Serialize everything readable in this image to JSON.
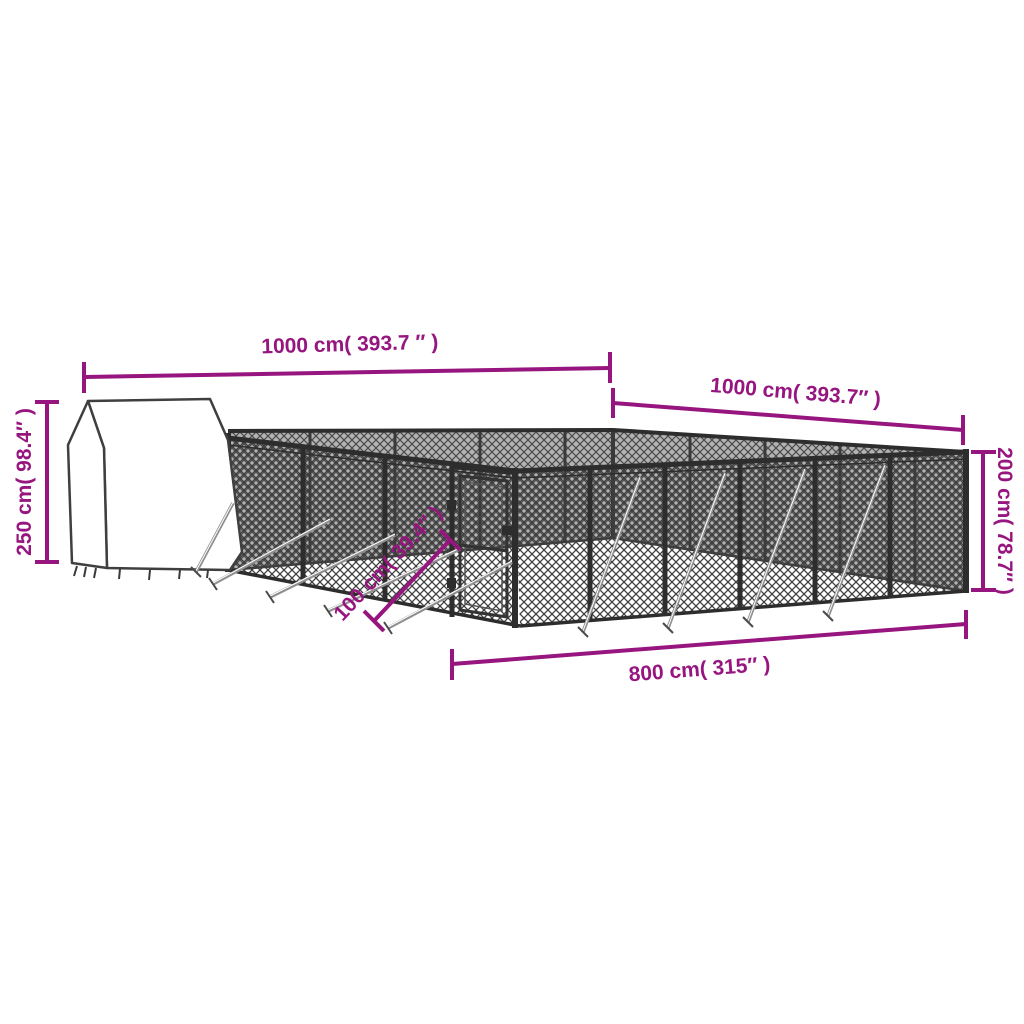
{
  "colors": {
    "dimension": "#97157F",
    "fence": "#2d2d2d",
    "mesh": "#4a4a4a",
    "background": "#ffffff"
  },
  "dimensions": {
    "top_left": {
      "label": "1000 cm( 393.7 ″ )"
    },
    "top_right": {
      "label": "1000 cm( 393.7″ )"
    },
    "left": {
      "label": "250 cm( 98.4″ )"
    },
    "right": {
      "label": "200 cm( 78.7″ )"
    },
    "bottom": {
      "label": "800 cm( 315″ )"
    },
    "gate": {
      "label": "100 cm( 39.4″ )"
    }
  }
}
